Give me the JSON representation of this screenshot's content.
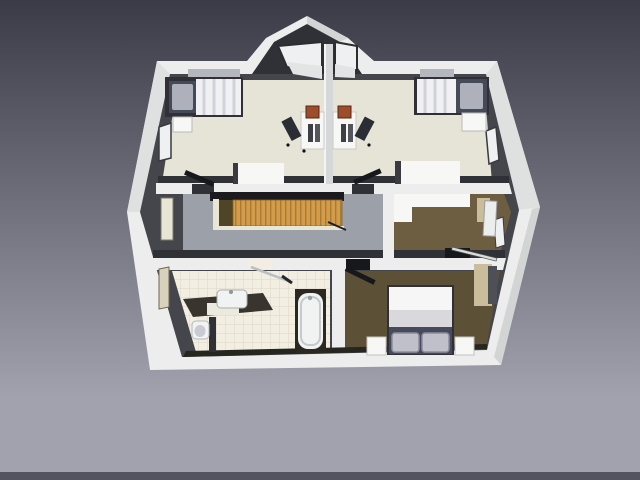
{
  "scene": {
    "kind": "3d-floor-plan-render",
    "description": "Cutaway top view render of an attic storey with two children's bedrooms, hallway with staircase, walk-in closet, bathroom and master bedroom",
    "background": {
      "top": "#3b3b47",
      "bottom": "#a2a2ae",
      "baseline_strip": "#53535f"
    },
    "colors": {
      "wall_white": "#ecedec",
      "wall_shade": "#d3d5d5",
      "roof_shade": "#dfe1e1",
      "inner_face": "#45454c",
      "inner_face_dark": "#303037",
      "floor_cream": "#e6e3d7",
      "floor_corridor": "#9ba0a9",
      "floor_tile": "#f2eee1",
      "tile_grid": "#dcd7c6",
      "floor_closet": "#6e5e41",
      "floor_master": "#5c5036",
      "stairs_wood": "#d39c4b",
      "stairs_tread": "#aa7c33",
      "stairs_dark": "#4f4526",
      "stairs_stringer": "#eae6d4",
      "stairwell_void": "#1b1b1f",
      "bed_frame": "#303036",
      "duvet": "#f1f1f3",
      "duvet_stripe": "#cfd2d8",
      "pillow_zone": "#454a58",
      "pillow": "#aeb1bc",
      "master_sheet": "#f6f6f7",
      "master_band": "#d8d8dd",
      "master_headboard": "#454a5c",
      "master_pillow": "#bfc0ca",
      "furniture_white": "#f7f7f6",
      "desk_monitor": "#9e4d2b",
      "chair_dark": "#2a2d33",
      "wardrobe_tan": "#c9bd9b",
      "counter_dark": "#39352e",
      "tub_surround": "#2b2822",
      "fixture_white": "#f1f2f2",
      "door_dark": "#17181c",
      "window_glass": "#eef0f2",
      "window_cream": "#e8e4d6",
      "window_behind": "#b4b7bd"
    },
    "rooms": [
      {
        "id": "bedroom-top-left",
        "floor_color": "#e6e3d7",
        "furniture": [
          "single-bed",
          "nightstand",
          "desk",
          "desk-chair",
          "dresser",
          "door"
        ]
      },
      {
        "id": "bedroom-top-right",
        "floor_color": "#e6e3d7",
        "furniture": [
          "single-bed",
          "nightstand",
          "desk",
          "desk-chair",
          "dresser",
          "door"
        ]
      },
      {
        "id": "hallway",
        "floor_color": "#9ba0a9",
        "furniture": [
          "staircase",
          "handrail"
        ]
      },
      {
        "id": "walk-in-closet",
        "floor_color": "#6e5e41",
        "furniture": [
          "built-in-closet",
          "wardrobe",
          "door"
        ]
      },
      {
        "id": "bathroom",
        "floor_color": "#f2eee1",
        "furniture": [
          "washbasin-counter",
          "sink",
          "toilet",
          "bathtub",
          "shower-screen"
        ]
      },
      {
        "id": "bedroom-master",
        "floor_color": "#5c5036",
        "furniture": [
          "double-bed",
          "nightstand-left",
          "nightstand-right",
          "wardrobe",
          "door"
        ]
      }
    ]
  }
}
